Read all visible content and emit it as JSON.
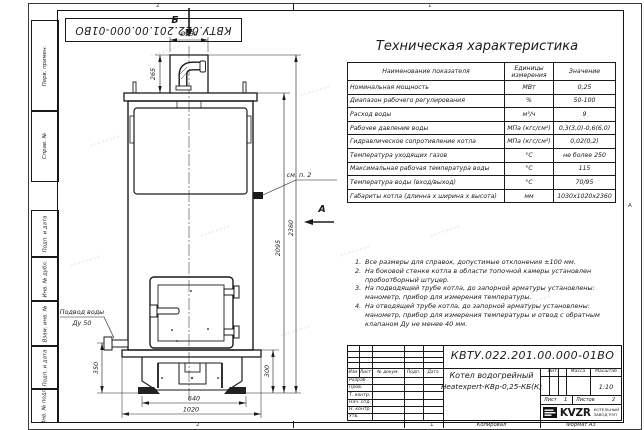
{
  "sheet": {
    "stamp_doc_number": "КВТУ.022.201.00.000-01ВО",
    "zone_top_left": "2",
    "zone_top_right": "1",
    "zone_bottom_left": "2",
    "zone_bottom_right": "1",
    "zone_right": "А",
    "side_labels": [
      "Перв. примен.",
      "Справ. №",
      "Подп. и дата",
      "Инв. № дубл.",
      "Взам. инв. №",
      "Подп. и дата",
      "Инв. № подл."
    ],
    "copied_label": "Копировал",
    "format_label": "Формат А3"
  },
  "spec_table": {
    "title": "Техническая характеристика",
    "col_headers": [
      "Наименование показателя",
      "Единицы измерения",
      "Значение"
    ],
    "rows": [
      [
        "Номинальная мощность",
        "МВт",
        "0,25"
      ],
      [
        "Диапазон рабочего регулирования",
        "%",
        "50-100"
      ],
      [
        "Расход воды",
        "м³/ч",
        "9"
      ],
      [
        "Рабочее давление воды",
        "МПа (кгс/см²)",
        "0,3(3,0)-0,6(6,0)"
      ],
      [
        "Гидравлическое сопротивление котла",
        "МПа (кгс/см²)",
        "0,02(0,2)"
      ],
      [
        "Температура уходящих газов",
        "°С",
        "не более 250"
      ],
      [
        "Максимальная рабочая температура воды",
        "°С",
        "115"
      ],
      [
        "Температура воды (вход/выход)",
        "°С",
        "70/95"
      ],
      [
        "Габариты котла (длинна х ширина х высота)",
        "мм",
        "1030х1020х2360"
      ]
    ]
  },
  "notes": {
    "items": [
      {
        "n": "1.",
        "text": "Все размеры для справок, допустимые отклонения ±100 мм."
      },
      {
        "n": "2.",
        "text": "На боковой стенке котла в области топочной камеры установлен пробоотборный штуцер."
      },
      {
        "n": "3.",
        "text": "На подводящей трубе котла, до запорной арматуры установлены: манометр, прибор для измерения температуры."
      },
      {
        "n": "4.",
        "text": "На отводящей трубе котла, до запорной арматуры установлены: манометр, прибор для измерения температуры и отвод с обратным клапаном Ду не менее 40 мм."
      }
    ]
  },
  "drawing": {
    "view_top": "Б",
    "view_side": "А",
    "see_note": "см. п. 2",
    "inlet_line1": "Подвод воды",
    "inlet_line2": "Ду 50",
    "dia": "Ø250",
    "dims": {
      "h_chimney": "265",
      "h_body": "2095",
      "h_total": "2360",
      "h_inlet": "350",
      "h_base": "300",
      "w_base": "640",
      "w_bottom": "1020"
    }
  },
  "title_block": {
    "doc_number": "КВТУ.022.201.00.000-01ВО",
    "product_line1": "Котел водогрейный",
    "product_line2": "Heatexpert-КВр-0,25-КБ(К)",
    "lit_header": "Лит.",
    "mass_header": "Масса",
    "scale_header": "Масштаб",
    "scale_value": "1:10",
    "sheet_header": "Лист",
    "sheet_value": "1",
    "sheets_header": "Листов",
    "sheets_value": "2",
    "rev_cols": [
      "Изм",
      "Лист",
      "№ докум.",
      "Подп.",
      "Дата"
    ],
    "roles": [
      "Разраб.",
      "Пров.",
      "Т. контр.",
      "Нач. отд.",
      "Н. контр.",
      "Утв."
    ],
    "brand": "KVZR",
    "brand_cap1": "КОТЕЛЬНЫЙ",
    "brand_cap2": "ЗАВОД РЭП"
  }
}
